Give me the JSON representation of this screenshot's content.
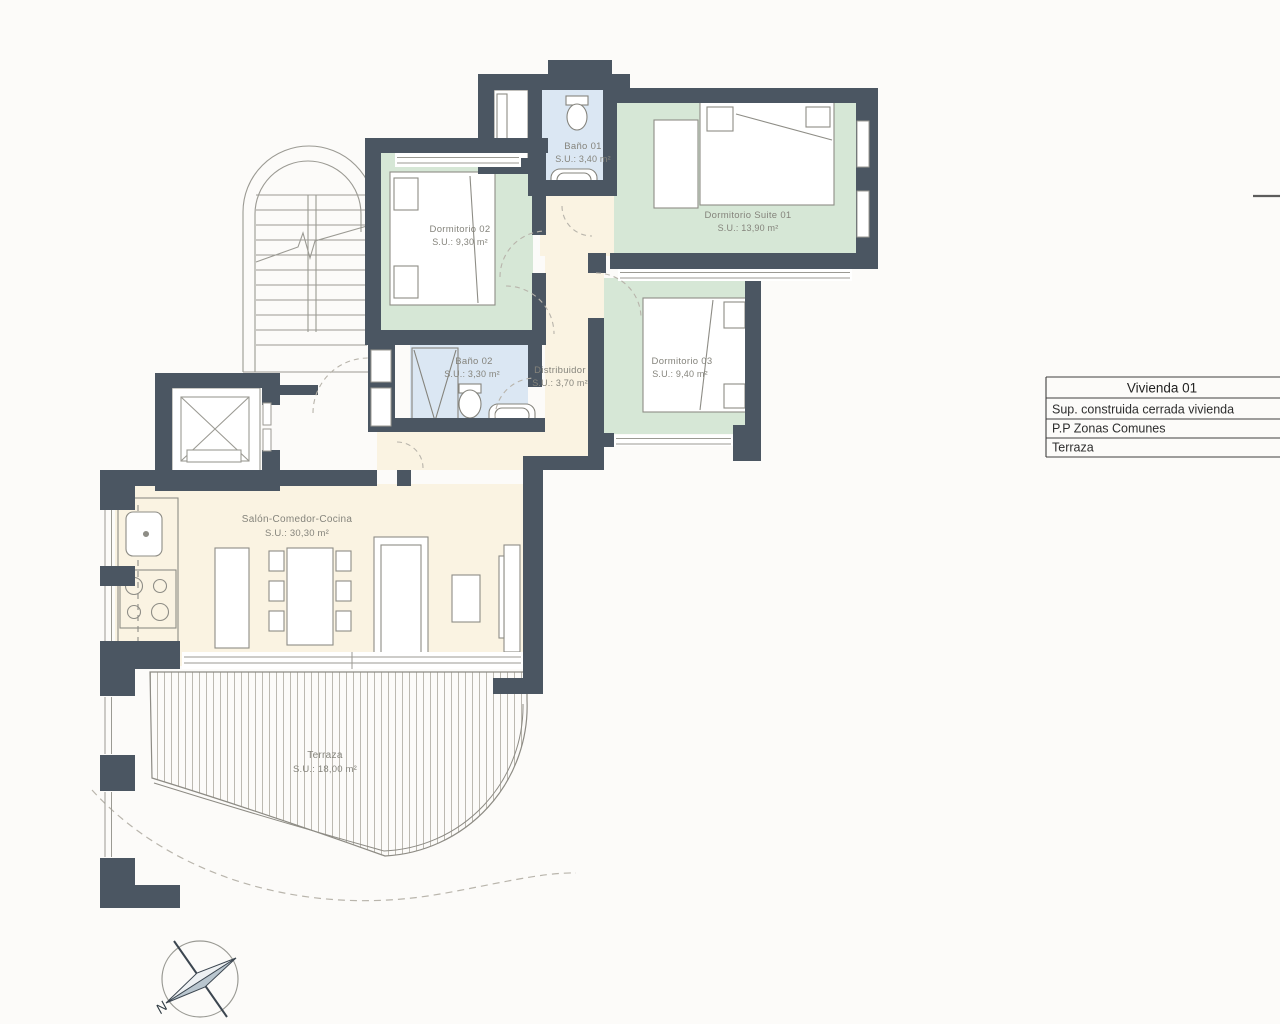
{
  "plan": {
    "rooms": [
      {
        "name": "Baño 01",
        "area": "S.U.: 3,40 m²"
      },
      {
        "name": "Dormitorio Suite 01",
        "area": "S.U.: 13,90 m²"
      },
      {
        "name": "Dormitorio 02",
        "area": "S.U.: 9,30 m²"
      },
      {
        "name": "Baño 02",
        "area": "S.U.: 3,30 m²"
      },
      {
        "name": "Distribuidor",
        "area": "S.U.: 3,70 m²"
      },
      {
        "name": "Dormitorio 03",
        "area": "S.U.: 9,40 m²"
      },
      {
        "name": "Salón-Comedor-Cocina",
        "area": "S.U.: 30,30 m²"
      },
      {
        "name": "Terraza",
        "area": "S.U.: 18,00 m²"
      }
    ],
    "compass": {
      "north_label": "N"
    }
  },
  "summary_table": {
    "header": "Vivienda 01",
    "rows": [
      {
        "label": "Sup. construida cerrada vivienda"
      },
      {
        "label": "P.P Zonas Comunes"
      },
      {
        "label": "Terraza"
      }
    ]
  },
  "colors": {
    "wall": "#4b5662",
    "bedroom_fill": "#d6e7d6",
    "bath_fill": "#dbe7f3",
    "living_fill": "#faf3e2",
    "label_text": "#85847c"
  }
}
